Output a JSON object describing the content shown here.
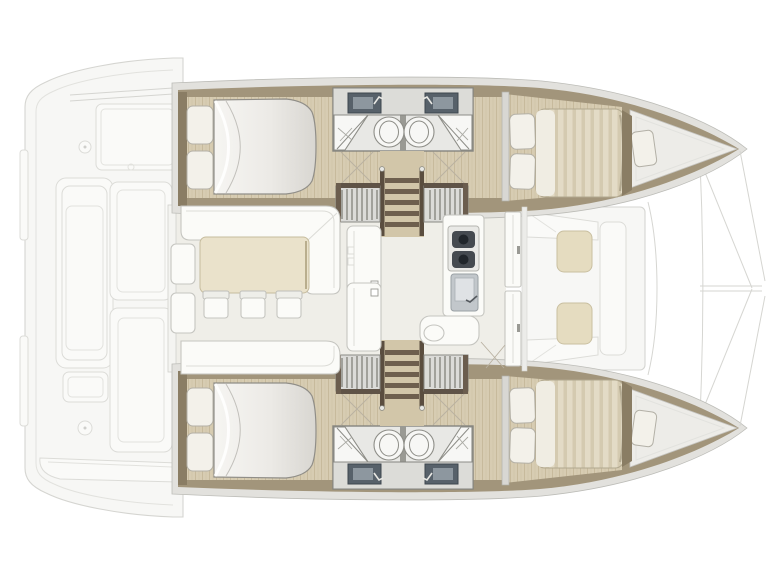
{
  "document": {
    "title": "Catamaran interior layout floor plan (top view, bow to the right)",
    "type": "boat-floor-plan"
  },
  "palette": {
    "background": "#ffffff",
    "ghost_line": "#d5d5d1",
    "ghost_fill": "#f7f7f5",
    "shell": "#e2e1dd",
    "wall": "#a2957b",
    "wall_dark": "#8a7d64",
    "wood": "#d7ccb2",
    "wood_grain": "#c7ba9c",
    "sofa_white": "#fbfbf8",
    "pillow": "#f3f1ea",
    "duvet": "#efeeea",
    "mattress": "#e3dbc6",
    "table": "#eae2cb",
    "cushion": "#e5dcc0",
    "bath_floor": "#e8e8e5",
    "sink_dark": "#57616a",
    "fixture": "#f7f7f5",
    "stair_rail": "#5a4d3f",
    "salon_floor": "#efeee8"
  },
  "vessel": {
    "hulls": [
      {
        "name": "port hull (top)",
        "rooms": [
          "aft double cabin with berth and 2 pillows",
          "bathroom: sink, toilet, shower",
          "second bathroom: sink, toilet, shower",
          "companionway stairs with rails",
          "forward double cabin with berth and 2 pillows",
          "forepeak with cushion"
        ]
      },
      {
        "name": "starboard hull (bottom)",
        "mirror_of": "port hull (top)"
      }
    ],
    "salon": {
      "furniture": [
        "L-shaped sofa (port side)",
        "sofa bench (starboard side)",
        "dining table",
        "3 chairs",
        "2 white side modules",
        "side table"
      ],
      "galley": [
        "counter",
        "stove with 2 burners",
        "sink with faucet",
        "rounded seat with stool"
      ]
    },
    "forward_cockpit": {
      "furniture": [
        "U bench seating",
        "2 beige cushions"
      ],
      "access": "double sliding door"
    },
    "aft_cockpit": {
      "style": "ghost outline",
      "elements": [
        "transom bench",
        "side bench",
        "cockpit modules",
        "2 winch circles",
        "aft bench"
      ]
    },
    "foredeck": {
      "style": "ghost outline",
      "elements": [
        "trampoline edge line",
        "forestay bridle lines",
        "bow tips"
      ]
    }
  },
  "counts": {
    "double_cabins": 4,
    "bathrooms": 4,
    "salon_chairs": 3,
    "forward_cockpit_cushions": 2
  }
}
